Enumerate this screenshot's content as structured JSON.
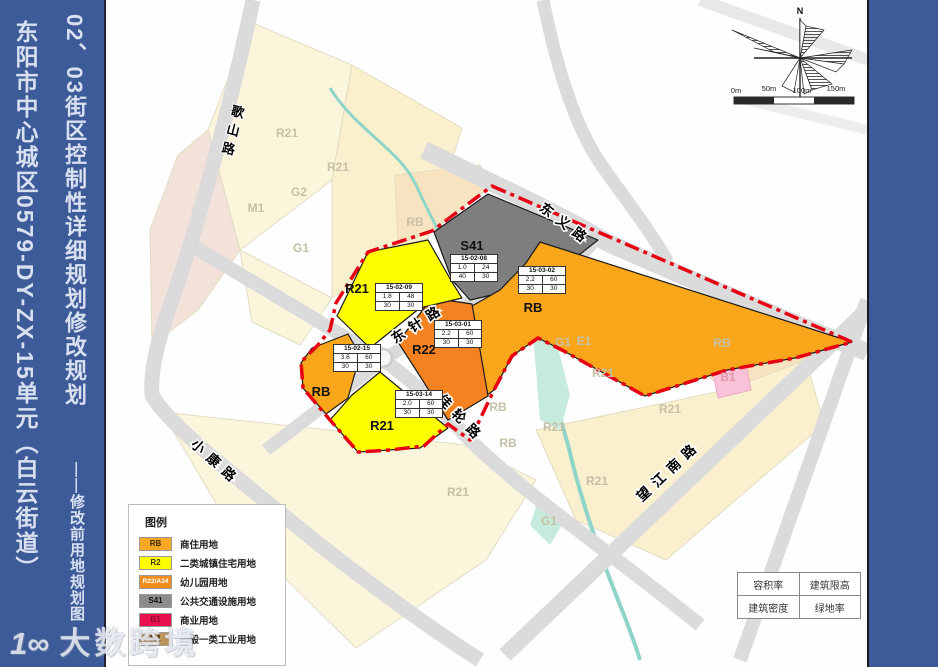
{
  "sidebar": {
    "title": "02、03街区控制性详细规划修改规划",
    "subtitle": "东阳市中心城区0579-DY-ZX-15单元（白云街道）",
    "note": "——修改前用地规划图"
  },
  "watermark": {
    "logo": "1∞",
    "text": "大数跨境"
  },
  "map": {
    "north_label": "N",
    "scale_labels": [
      "0m",
      "50m",
      "100m",
      "150m"
    ],
    "colors": {
      "rb": "#FAA61A",
      "r2": "#FFFF00",
      "r22": "#F58220",
      "s41": "#7E7E7E",
      "b1": "#E8104E",
      "m1": "#BE935B",
      "boundary": "#E60012",
      "road": "#DBDBDB",
      "sidebar_blue": "#3D5A99"
    },
    "roads": [
      {
        "name": "歌山路"
      },
      {
        "name": "东义路"
      },
      {
        "name": "东针路"
      },
      {
        "name": "佳轮路"
      },
      {
        "name": "小康路"
      },
      {
        "name": "望江南路"
      }
    ],
    "parcels": [
      {
        "label": "R21",
        "id": "15-02-09",
        "far": "1.8",
        "height": "48",
        "density": "30",
        "green": "30"
      },
      {
        "label": "S41",
        "id": "15-02-08",
        "far": "1.0",
        "height": "24",
        "density": "40",
        "green": "30"
      },
      {
        "label": "RB",
        "id": "15-03-02",
        "far": "2.2",
        "height": "60",
        "density": "30",
        "green": "30"
      },
      {
        "label": "R22",
        "id": "15-03-01",
        "far": "2.2",
        "height": "60",
        "density": "30",
        "green": "30"
      },
      {
        "label": "RB",
        "id": "15-02-15",
        "far": "3.6",
        "height": "60",
        "density": "30",
        "green": "30"
      },
      {
        "label": "R21",
        "id": "15-03-14",
        "far": "2.0",
        "height": "60",
        "density": "30",
        "green": "30"
      }
    ],
    "faded_labels": [
      {
        "text": "R21"
      },
      {
        "text": "R21"
      },
      {
        "text": "G2"
      },
      {
        "text": "M1"
      },
      {
        "text": "G1"
      },
      {
        "text": "RB"
      },
      {
        "text": "G1"
      },
      {
        "text": "E1"
      },
      {
        "text": "RB"
      },
      {
        "text": "B1"
      },
      {
        "text": "R21"
      },
      {
        "text": "R21"
      },
      {
        "text": "R21"
      },
      {
        "text": "R21"
      },
      {
        "text": "G1"
      },
      {
        "text": "RB"
      },
      {
        "text": "RB"
      },
      {
        "text": "R21"
      }
    ],
    "legend": {
      "title": "图例",
      "items": [
        {
          "code": "RB",
          "color": "#F9A825",
          "text_color": "#3A2A00",
          "label": "商住用地"
        },
        {
          "code": "R2",
          "color": "#FFFF00",
          "text_color": "#3A3A00",
          "label": "二类城镇住宅用地"
        },
        {
          "code": "R22/A34",
          "color": "#F28C1E",
          "text_color": "#FFFFFF",
          "label": "幼儿园用地"
        },
        {
          "code": "S41",
          "color": "#8C8C8C",
          "text_color": "#111111",
          "label": "公共交通设施用地"
        },
        {
          "code": "B1",
          "color": "#E8104E",
          "text_color": "#8F0E2E",
          "label": "商业用地"
        },
        {
          "code": "M1",
          "color": "#BE935B",
          "text_color": "#2E1F05",
          "label": "一般一类工业用地"
        }
      ]
    },
    "key_table": {
      "r1c1": "容积率",
      "r1c2": "建筑限高",
      "r2c1": "建筑密度",
      "r2c2": "绿地率"
    }
  }
}
